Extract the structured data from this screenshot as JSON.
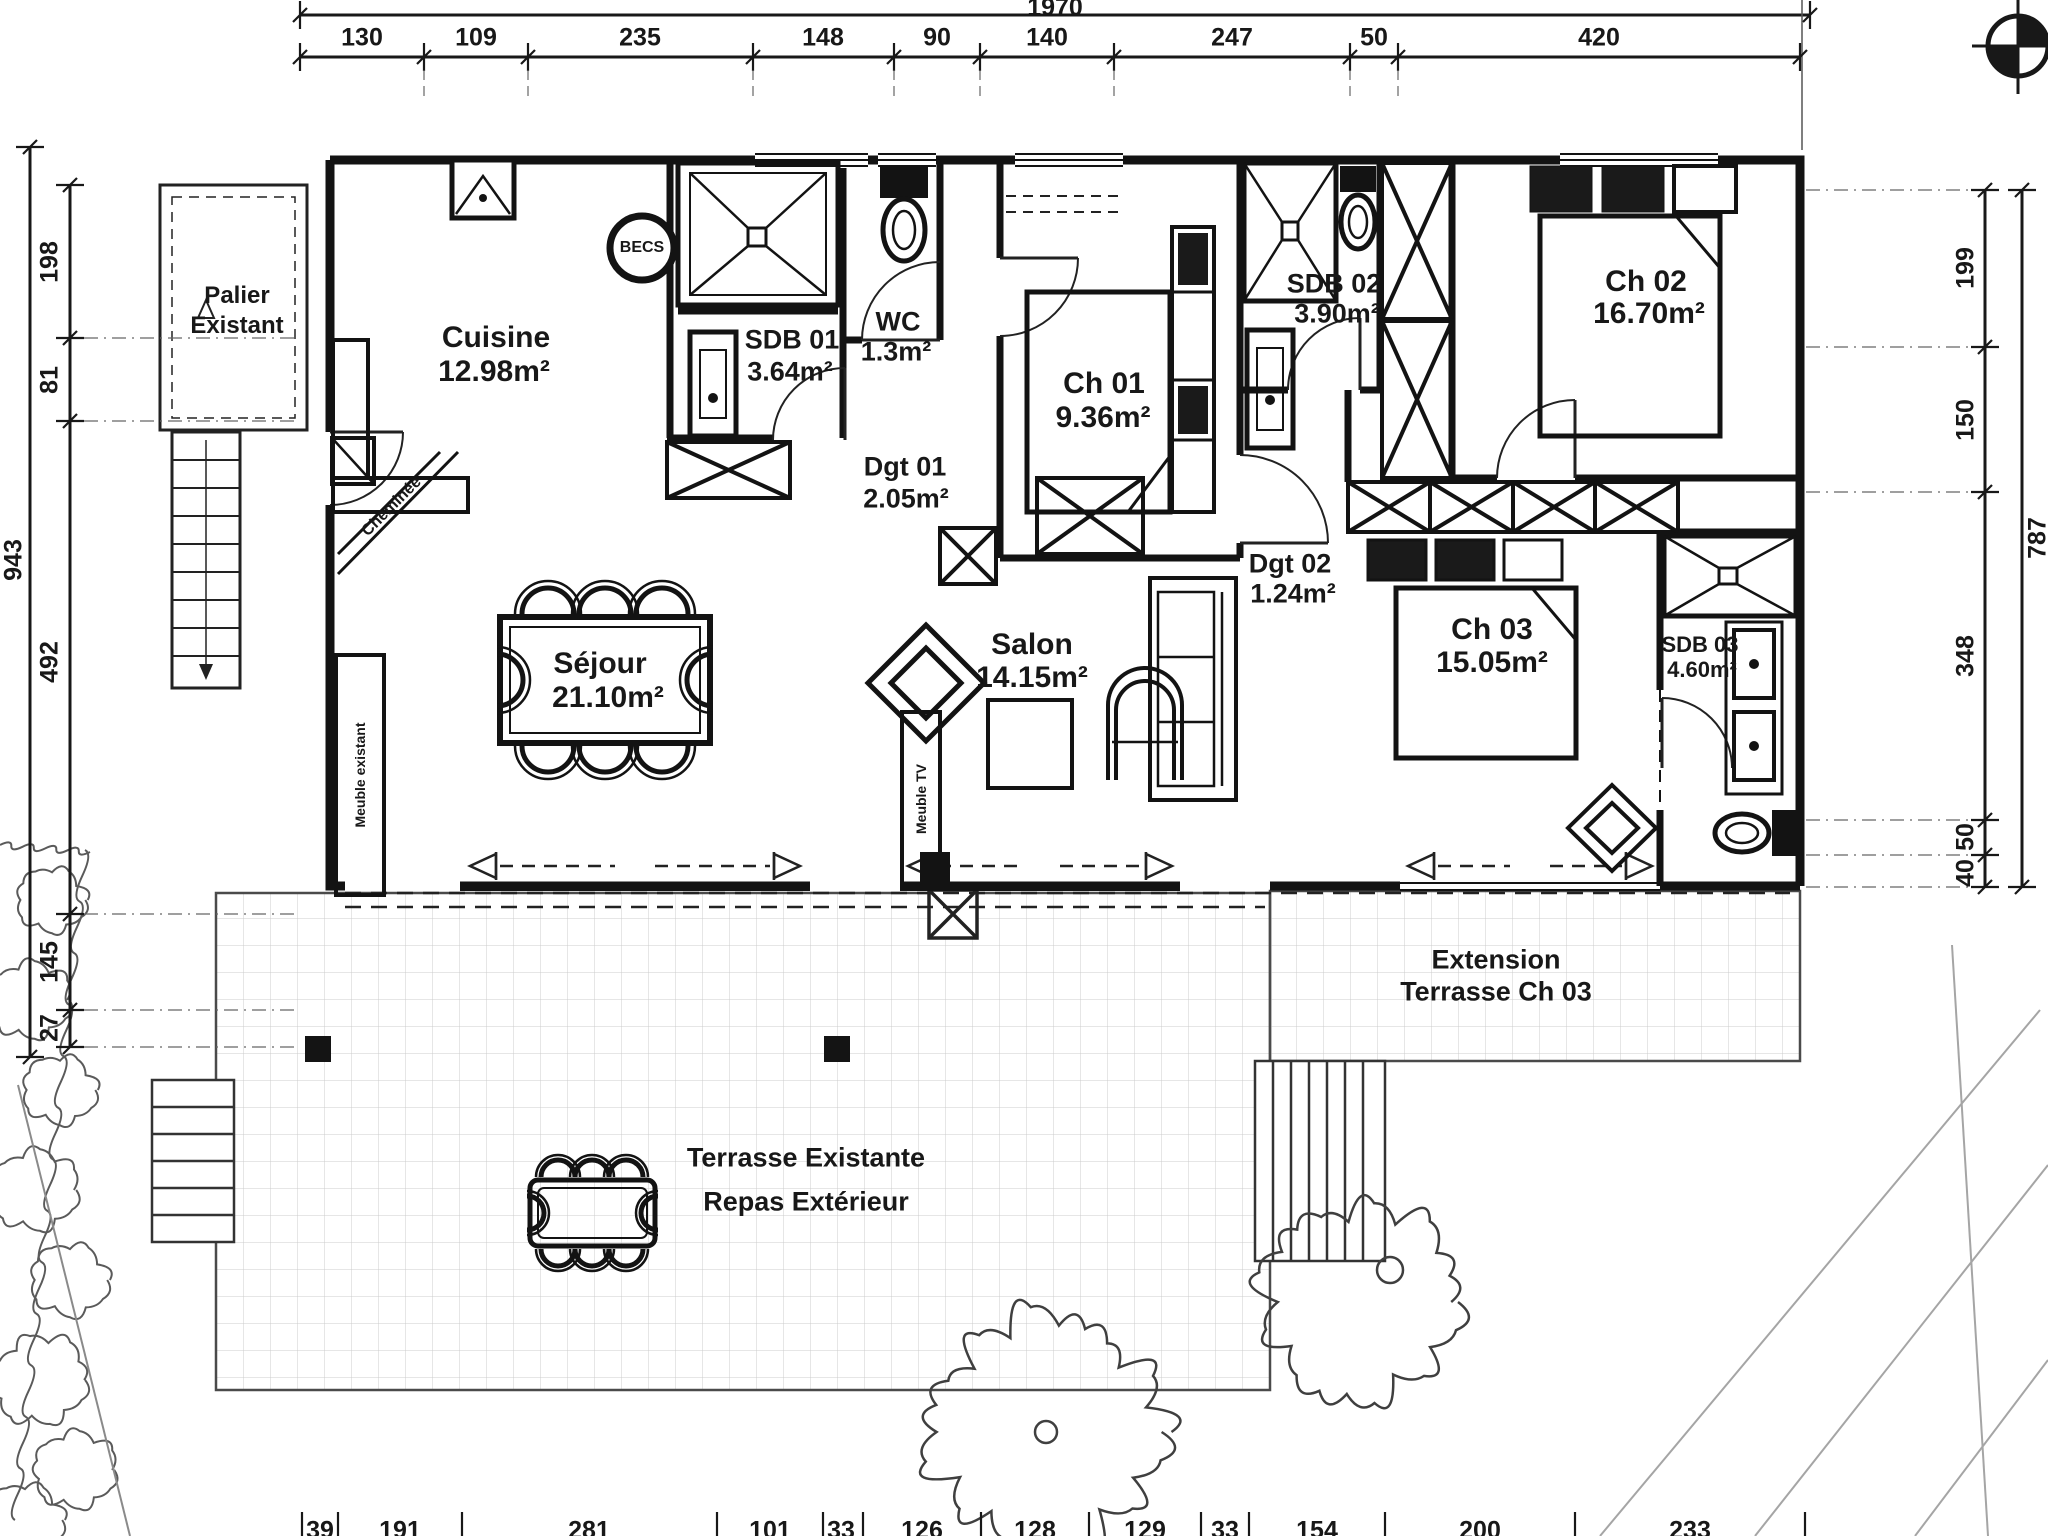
{
  "drawing": {
    "rooms": [
      {
        "id": "palier",
        "name": "Palier",
        "area": "Existant"
      },
      {
        "id": "cuisine",
        "name": "Cuisine",
        "area": "12.98m²"
      },
      {
        "id": "sdb01",
        "name": "SDB 01",
        "area": "3.64m²"
      },
      {
        "id": "wc",
        "name": "WC",
        "area": "1.3m²"
      },
      {
        "id": "dgt01",
        "name": "Dgt 01",
        "area": "2.05m²"
      },
      {
        "id": "ch01",
        "name": "Ch 01",
        "area": "9.36m²"
      },
      {
        "id": "sdb02",
        "name": "SDB 02",
        "area": "3.90m²"
      },
      {
        "id": "ch02",
        "name": "Ch 02",
        "area": "16.70m²"
      },
      {
        "id": "sejour",
        "name": "Séjour",
        "area": "21.10m²"
      },
      {
        "id": "salon",
        "name": "Salon",
        "area": "14.15m²"
      },
      {
        "id": "dgt02",
        "name": "Dgt 02",
        "area": "1.24m²"
      },
      {
        "id": "ch03",
        "name": "Ch 03",
        "area": "15.05m²"
      },
      {
        "id": "sdb03",
        "name": "SDB 03",
        "area": "4.60m²"
      },
      {
        "id": "extension",
        "name": "Extension",
        "area": "Terrasse Ch 03"
      },
      {
        "id": "terrasse",
        "name": "Terrasse Existante",
        "area": "Repas Extérieur"
      }
    ],
    "annotations": {
      "becs": "BECS",
      "cheminee": "Cheminée",
      "meuble_existant": "Meuble existant",
      "meuble_tv": "Meuble TV"
    },
    "dimensions": {
      "top_total": "1970",
      "top": [
        "130",
        "109",
        "235",
        "148",
        "90",
        "140",
        "247",
        "50",
        "420"
      ],
      "left_outer": "943",
      "left": [
        "198",
        "81",
        "492",
        "145",
        "27"
      ],
      "right_outer": "787",
      "right": [
        "199",
        "150",
        "348",
        "50",
        "40"
      ],
      "bottom": [
        "39",
        "191",
        "281",
        "101",
        "33",
        "126",
        "128",
        "129",
        "33",
        "154",
        "200",
        "233"
      ]
    },
    "icons": {
      "north_symbol": "compass-crosshair-icon"
    },
    "colors": {
      "ink": "#181818",
      "paper": "#ffffff",
      "tile": "#cccccc",
      "faint": "#9a9a9a"
    }
  }
}
